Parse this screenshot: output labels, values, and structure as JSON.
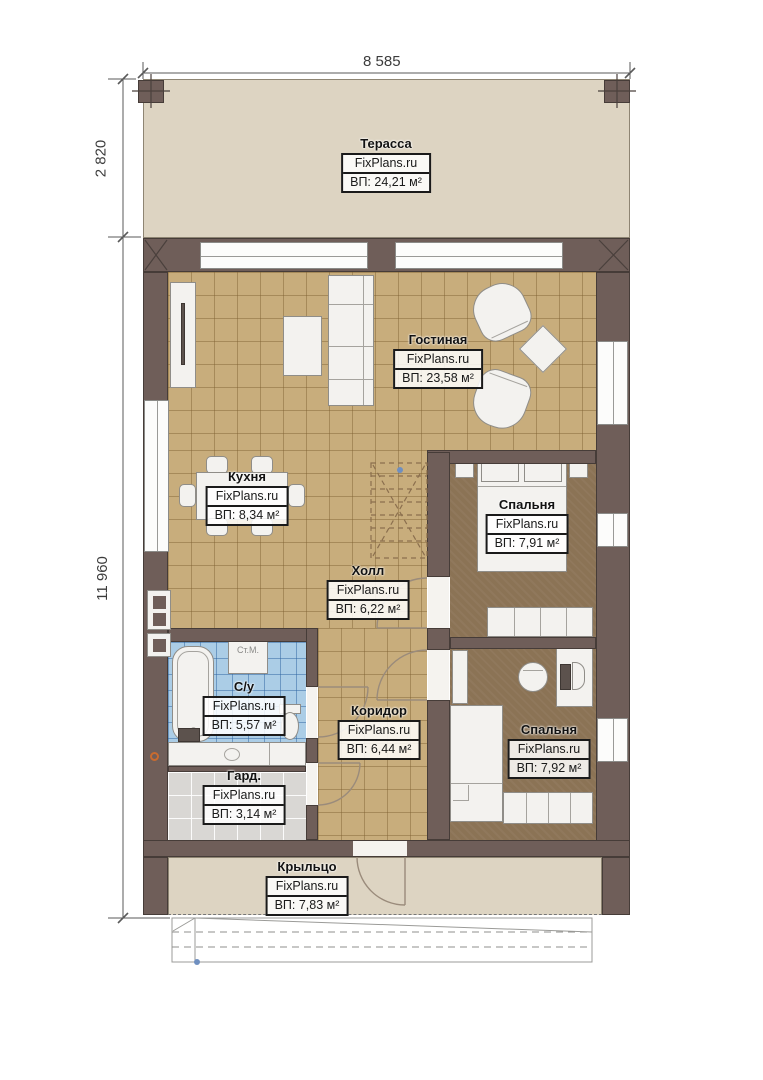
{
  "dims": {
    "width": "8 585",
    "terrace_depth": "2 820",
    "house_depth": "11 960"
  },
  "watermark": "FixPlans.ru",
  "rooms": {
    "terrace": {
      "name": "Терасса",
      "area": "ВП: 24,21 м²"
    },
    "living": {
      "name": "Гостиная",
      "area": "ВП: 23,58 м²"
    },
    "kitchen": {
      "name": "Кухня",
      "area": "ВП: 8,34 м²"
    },
    "bedroom1": {
      "name": "Спальня",
      "area": "ВП: 7,91 м²"
    },
    "hall": {
      "name": "Холл",
      "area": "ВП: 6,22 м²"
    },
    "bathroom": {
      "name": "С/у",
      "area": "ВП: 5,57 м²"
    },
    "corridor": {
      "name": "Коридор",
      "area": "ВП: 6,44 м²"
    },
    "wardrobe": {
      "name": "Гард.",
      "area": "ВП: 3,14 м²"
    },
    "bedroom2": {
      "name": "Спальня",
      "area": "ВП: 7,92 м²"
    },
    "porch": {
      "name": "Крыльцо",
      "area": "ВП: 7,83 м²"
    }
  },
  "appliances": {
    "washing_machine": "Ст.М."
  },
  "colors": {
    "wall": "#6f5e59",
    "floor_tile": "#c8ad7c",
    "carpet": "#8b7355",
    "bath_tile": "#abcde6",
    "terrace": "#ddd4c2"
  }
}
